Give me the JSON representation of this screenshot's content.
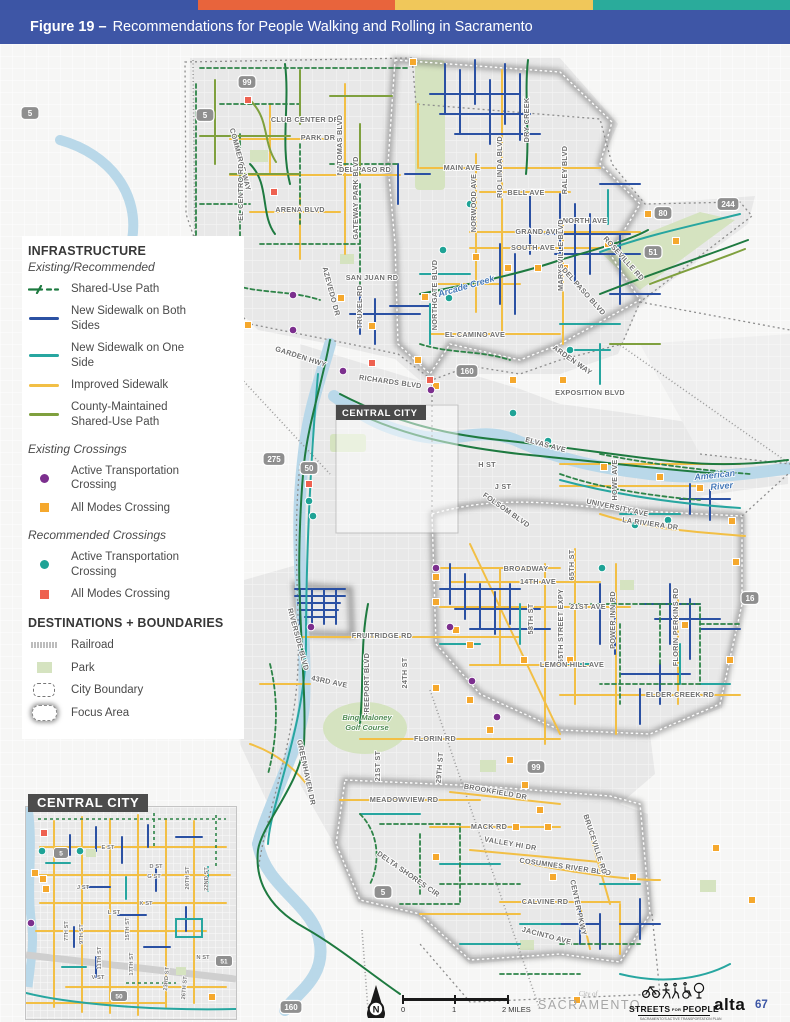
{
  "stripe_colors": [
    "#3c55a5",
    "#e8643c",
    "#f0c75a",
    "#2aab9b"
  ],
  "header": {
    "figure_label": "Figure 19 –",
    "title": "Recommendations for People Walking and Rolling in Sacramento"
  },
  "legend": {
    "infrastructure": {
      "heading": "INFRASTRUCTURE",
      "subheading": "Existing/Recommended",
      "items": [
        {
          "label": "Shared-Use Path",
          "color": "#1e7a40"
        },
        {
          "label": "New Sidewalk on Both Sides",
          "color": "#2b51a3"
        },
        {
          "label": "New Sidewalk on One Side",
          "color": "#27a6a0"
        },
        {
          "label": "Improved Sidewalk",
          "color": "#f2bf45"
        },
        {
          "label": "County-Maintained Shared-Use Path",
          "color": "#7fa03e"
        }
      ]
    },
    "existing_crossings": {
      "heading": "Existing Crossings",
      "items": [
        {
          "label": "Active Transportation Crossing",
          "marker": "circle",
          "color": "#7c2f8e"
        },
        {
          "label": "All Modes Crossing",
          "marker": "square",
          "color": "#f5a82d"
        }
      ]
    },
    "recommended_crossings": {
      "heading": "Recommended Crossings",
      "items": [
        {
          "label": "Active Transportation Crossing",
          "marker": "circle",
          "color": "#1fa396"
        },
        {
          "label": "All Modes Crossing",
          "marker": "square",
          "color": "#ee6150"
        }
      ]
    },
    "destinations": {
      "heading": "DESTINATIONS + BOUNDARIES",
      "items": [
        {
          "label": "Railroad"
        },
        {
          "label": "Park",
          "color": "#d5e3c0"
        },
        {
          "label": "City Boundary"
        },
        {
          "label": "Focus Area"
        }
      ]
    }
  },
  "map": {
    "focus_label": "CENTRAL CITY",
    "labels": {
      "commerce_way": "COMMERCE WAY",
      "club_center_dr": "CLUB CENTER DR",
      "park_dr": "PARK DR",
      "natomas_blvd": "NATOMAS BLVD",
      "del_paso_rd": "DEL PASO RD",
      "el_centro_rd": "EL CENTRO RD",
      "arena_blvd": "ARENA BLVD",
      "gateway_park_blvd": "GATEWAY PARK BLVD",
      "main_ave": "MAIN AVE",
      "norwood_ave": "NORWOOD AVE",
      "rio_linda_blvd": "RIO LINDA BLVD",
      "dry_creek": "DRY CREEK",
      "bell_ave": "BELL AVE",
      "raley_blvd": "RALEY BLVD",
      "north_ave": "NORTH AVE",
      "grand_ave": "GRAND AVE",
      "south_ave": "SOUTH AVE",
      "marysville_blvd": "MARYSVILLE BLVD",
      "san_juan_rd": "SAN JUAN RD",
      "truxel_rd": "TRUXEL RD",
      "azevedo_dr": "AZEVEDO DR",
      "northgate_blvd": "NORTHGATE BLVD",
      "el_camino_ave": "EL CAMINO AVE",
      "garden_hwy": "GARDEN HWY",
      "richards_blvd": "RICHARDS BLVD",
      "exposition_blvd": "EXPOSITION BLVD",
      "roseville_rd": "ROSEVILLE RD",
      "del_paso_blvd": "DEL PASO BLVD",
      "arden_way": "ARDEN WAY",
      "elvas_ave": "ELVAS AVE",
      "h_st": "H ST",
      "j_st": "J ST",
      "folsom_blvd": "FOLSOM BLVD",
      "howe_ave": "HOWE AVE",
      "university_ave": "UNIVERSITY AVE",
      "la_riviera_dr": "LA RIVIERA DR",
      "broadway": "BROADWAY",
      "ave_14th": "14TH AVE",
      "ave_21st": "21ST AVE",
      "st_58th": "58TH ST",
      "st_65th": "65TH ST",
      "expy_65th": "65TH STREET EXPY",
      "power_inn_rd": "POWER INN RD",
      "lemon_hill_ave": "LEMON HILL AVE",
      "florin_perkins_rd": "FLORIN PERKINS RD",
      "elder_creek_rd": "ELDER CREEK RD",
      "fruitridge_rd": "FRUITRIDGE RD",
      "ave_43rd": "43RD AVE",
      "freeport_blvd": "FREEPORT BLVD",
      "st_24th": "24TH ST",
      "florin_rd": "FLORIN RD",
      "st_21st": "21ST ST",
      "st_29th": "29TH ST",
      "greenhaven_dr": "GREENHAVEN DR",
      "riverside_blvd": "RIVERSIDE BLVD",
      "meadowview_rd": "MEADOWVIEW RD",
      "brookfield_dr": "BROOKFIELD DR",
      "mack_rd": "MACK RD",
      "valley_hi_dr": "VALLEY HI DR",
      "cosumnes_river_blvd": "COSUMNES RIVER BLVD",
      "bruceville_rd": "BRUCEVILLE RD",
      "delta_shores_cir": "DELTA SHORES CIR",
      "calvine_rd": "CALVINE RD",
      "center_pkwy": "CENTER PKWY",
      "jacinto_ave": "JACINTO AVE",
      "american_1": "American",
      "american_2": "River",
      "sacramento_river": "Sacramento River",
      "arcade_creek": "Arcade Creek",
      "bing_1": "Bing Maloney",
      "bing_2": "Golf Course"
    },
    "shields": {
      "sr99_n": "99",
      "i5_n": "5",
      "i5_w": "5",
      "i80": "80",
      "sr244": "244",
      "sr51": "51",
      "sr160_n": "160",
      "sr275": "275",
      "us50": "50",
      "sr16": "16",
      "sr99_s": "99",
      "i5_s": "5",
      "sr160_s": "160"
    }
  },
  "inset": {
    "title": "CENTRAL CITY",
    "labels": {
      "e_st": "E ST",
      "d_st": "D ST",
      "g_st": "G ST",
      "j_st": "J ST",
      "k_st": "K ST",
      "l_st": "L ST",
      "n_st": "N ST",
      "v_st": "V ST",
      "st7": "7TH ST",
      "st9": "9TH ST",
      "st11": "11TH ST",
      "st15": "15TH ST",
      "st17": "17TH ST",
      "st20": "20TH ST",
      "st22": "22ND ST",
      "st23": "23RD ST",
      "st26": "26TH ST"
    },
    "shields": {
      "i5": "5",
      "us50": "50",
      "sr51": "51"
    }
  },
  "footer": {
    "north_letter": "N",
    "scale_ticks": [
      "0",
      "1",
      "2 MILES"
    ],
    "sacramento_pre": "City of",
    "sacramento_name": "SACRAMENTO",
    "sp_word1": "STREETS",
    "sp_mid": "FOR",
    "sp_word2": "PEOPLE",
    "sp_tagline": "SACRAMENTO'S ACTIVE TRANSPORTATION PLAN",
    "alta": "alta",
    "page_number": "67"
  }
}
